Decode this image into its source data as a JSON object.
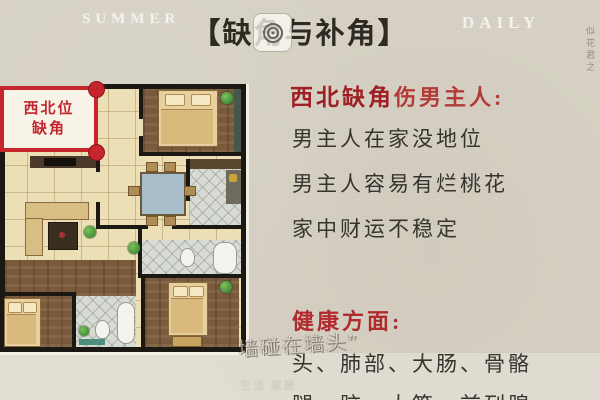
{
  "header": {
    "watermark_left": "SUMMER",
    "watermark_right": "DAILY",
    "title": "【缺角与补角】",
    "side_calligraphy": "似花君之"
  },
  "floor_plan": {
    "corner_label": {
      "line1": "西北位",
      "line2": "缺角"
    }
  },
  "content": {
    "heading": {
      "strong": "西北缺角",
      "rest": "伤男主人:"
    },
    "lines": [
      "男主人在家没地位",
      "男主人容易有烂桃花",
      "家中财运不稳定"
    ],
    "health": {
      "heading": "健康方面:",
      "lines": [
        "头、肺部、大肠、骨骼",
        "腿、脑、大筋、前列腺"
      ]
    }
  },
  "watermarks": {
    "center": "墙碰在墙头”",
    "bottom": "生活 家居"
  },
  "colors": {
    "paper": "#d7d2c5",
    "accent_red": "#c5252b",
    "heading_dark_red": "#9e2024",
    "heading_red": "#b43a38",
    "body_text": "#36342e"
  }
}
